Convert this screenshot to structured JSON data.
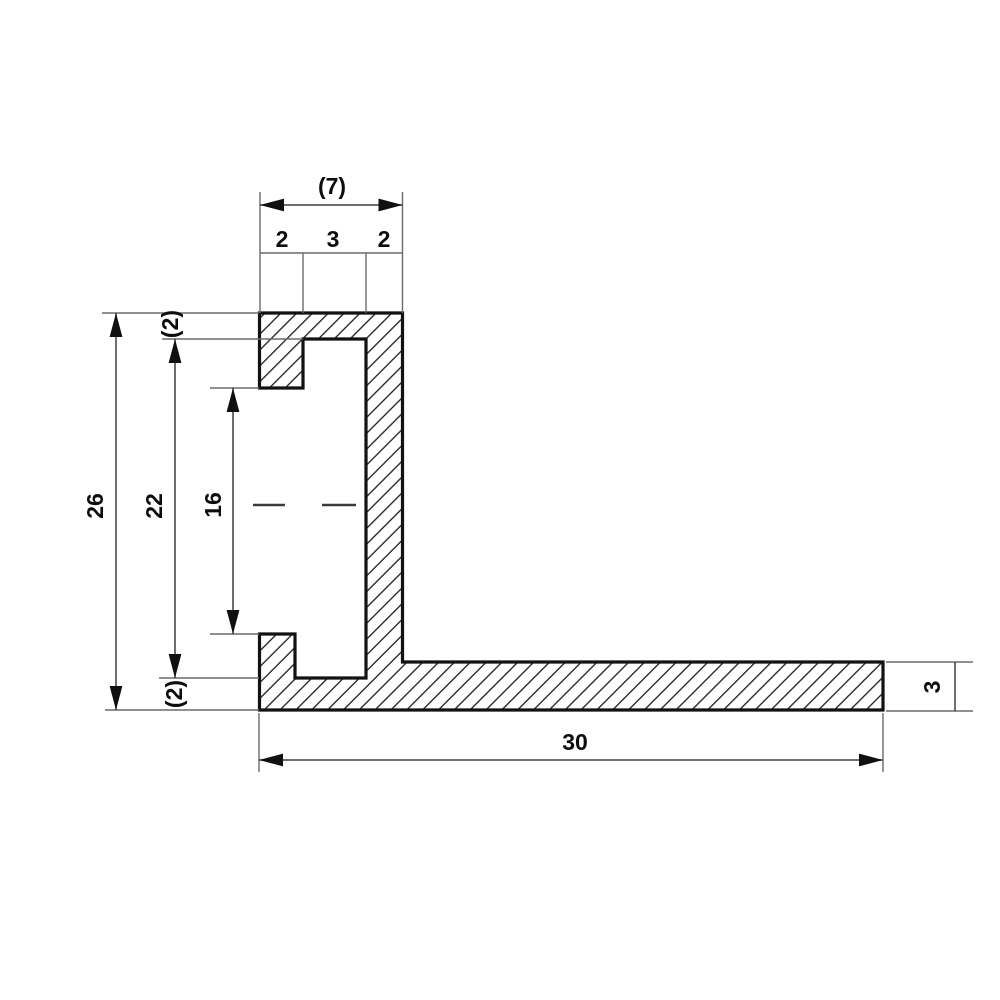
{
  "dims": {
    "top_width_ref": "(7)",
    "chain": [
      "2",
      "3",
      "2"
    ],
    "height_overall": "26",
    "height_inner": "22",
    "height_groove": "16",
    "lip_top_ref": "(2)",
    "lip_bottom_ref": "(2)",
    "bottom_width": "30",
    "flange_thickness": "3"
  }
}
